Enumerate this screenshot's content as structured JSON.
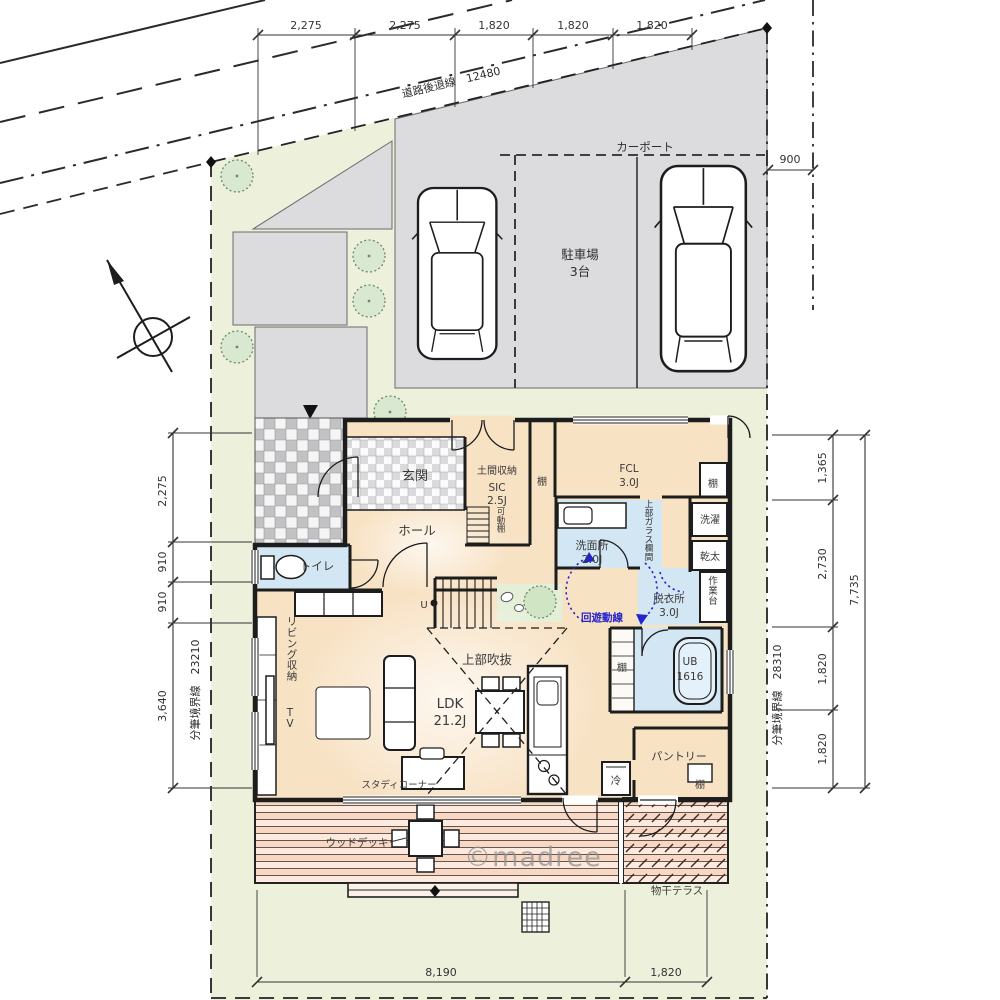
{
  "watermark": "©madree",
  "site": {
    "road_setback": "道路後退線　12480",
    "boundary_left": "分筆境界線　23210",
    "boundary_right": "分筆境界線　28310",
    "carport": "カーポート",
    "parking_name": "駐車場",
    "parking_count": "3台"
  },
  "dimensions": {
    "top": [
      "2,275",
      "2,275",
      "1,820",
      "1,820",
      "1,820"
    ],
    "top_right": "900",
    "left": [
      "2,275",
      "910",
      "910",
      "3,640"
    ],
    "right": [
      "1,365",
      "2,730",
      "1,820",
      "1,820"
    ],
    "right_total": "7,735",
    "bottom": [
      "8,190",
      "1,820"
    ]
  },
  "rooms": {
    "genkan": "玄関",
    "doma_storage": "土間収納",
    "sic_name": "SIC",
    "sic_size": "2.5J",
    "sic_shelf_note": "可動棚",
    "shelf": "棚",
    "hall": "ホール",
    "toilet": "トイレ",
    "fcl_name": "FCL",
    "fcl_size": "3.0J",
    "laundry": "洗濯",
    "dryer": "乾太",
    "worktop": "作業台",
    "senmen_name": "洗面所",
    "senmen_size": "2.0J",
    "glass_note": "上部ガラス欄間",
    "datsui_name": "脱衣所",
    "datsui_size": "3.0J",
    "bath_name": "UB",
    "bath_size": "1616",
    "stairs_up": "U",
    "living_storage": "リビング収納",
    "tv": "TV",
    "void_above": "上部吹抜",
    "ldk_name": "LDK",
    "ldk_size": "21.2J",
    "study": "スタディコーナー",
    "pantry": "パントリー",
    "fridge": "冷",
    "wood_deck": "ウッドデッキ",
    "terrace": "物干テラス",
    "circulation": "回遊動線"
  },
  "colors": {
    "lawn": "#edf1dc",
    "pavement": "#dcdcde",
    "floor": "#f8e2c4",
    "wet_blue": "#d2e6f4",
    "deck_pink": "#f6d8c4",
    "annotation_blue": "#2424cc",
    "line": "#1d1d1d"
  }
}
